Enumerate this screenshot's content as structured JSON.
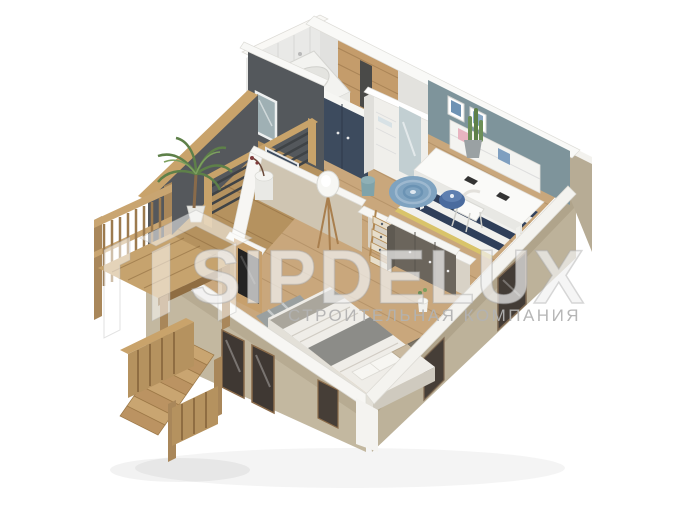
{
  "watermark": {
    "brand": "SIPDELUX",
    "tagline": "СТРОИТЕЛЬНАЯ КОМПАНИЯ",
    "brand_color": "rgba(255,255,255,0.62)",
    "tagline_color": "#b2b2b2"
  },
  "scene": {
    "background": "#ffffff",
    "colors": {
      "floor_wood": "#c9a77c",
      "balcony_deck": "#b5925f",
      "facade_beige": "#c3b8a0",
      "wall_cut_top": "#f7f6f3",
      "navy_cabinet": "#3d4b5e",
      "teal_wall": "#7e949b",
      "dark_balcony_wall": "#55585c",
      "shower_wood": "#c49c6b",
      "rug_navy": "#2f3f5a",
      "round_rug_blue": "#7fa3c0",
      "bedding": "#efede8",
      "window_glass_dark": "#3f3833",
      "stair_wood": "#c9a571",
      "plant_green": "#5e8049"
    }
  }
}
